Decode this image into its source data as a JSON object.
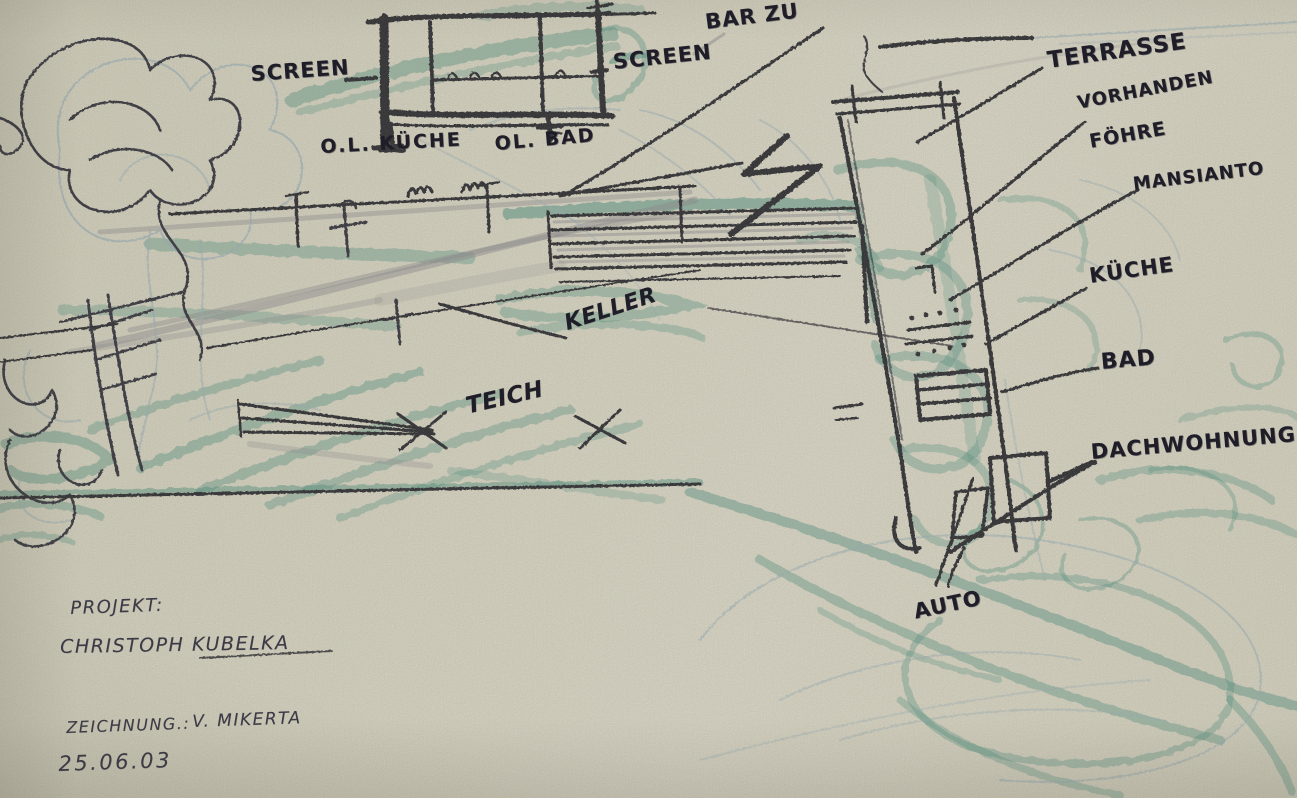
{
  "page": {
    "description": "Hand-drawn architectural concept sketch, black marker with teal crayon and pencil on beige paper"
  },
  "annotations": {
    "screen_left": "SCREEN",
    "screen_right": "SCREEN",
    "bar_zu": "BAR ZU",
    "ol_kueche": "O.L. KÜCHE",
    "ol_bad": "OL. BAD",
    "terrasse": "TERRASSE",
    "vorhanden": "VORHANDEN",
    "foehre": "FÖHRE",
    "mansianto": "MANSIANTO",
    "kueche": "KÜCHE",
    "bad": "BAD",
    "dachwohnung": "DACHWOHNUNG",
    "auto": "AUTO",
    "keller": "KELLER",
    "teich": "TEICH"
  },
  "title_block": {
    "project_label": "PROJEKT:",
    "project_name": "CHRISTOPH KUBELKA",
    "drawing_label": "ZEICHNUNG.:",
    "drawing_author": "V. MIKERTA",
    "date": "25.06.03"
  },
  "colors": {
    "paper": "#dedbca",
    "marker_ink": "#21202b",
    "teal_crayon": "#3d8b7b",
    "pencil_blue": "#9cb4bf",
    "graphite": "#8b8a92"
  }
}
